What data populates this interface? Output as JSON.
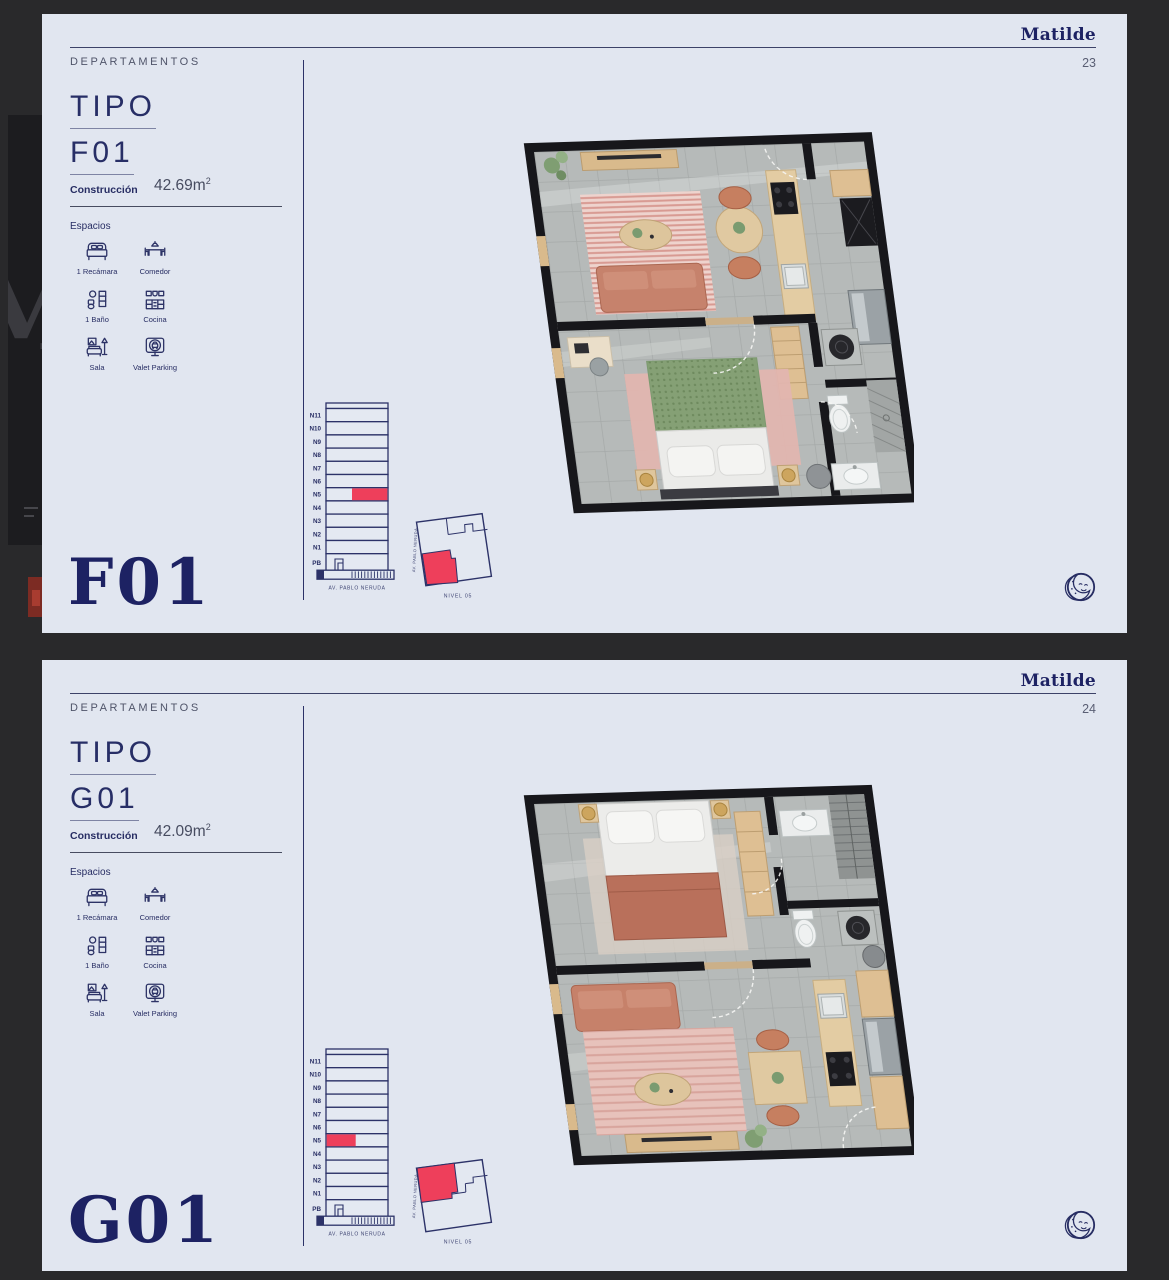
{
  "background": {
    "letter": "M"
  },
  "pages": [
    {
      "brand": "Matilde",
      "page_number": "23",
      "section_label": "DEPARTAMENTOS",
      "tipo": {
        "line1": "TIPO",
        "line2": "F01"
      },
      "construction": {
        "label": "Construcción",
        "value": "42.69m",
        "sup": "2"
      },
      "espacios_label": "Espacios",
      "spaces": [
        {
          "icon": "bed-icon",
          "label": "1 Recámara"
        },
        {
          "icon": "dining-icon",
          "label": "Comedor"
        },
        {
          "icon": "bath-icon",
          "label": "1 Baño"
        },
        {
          "icon": "kitchen-icon",
          "label": "Cocina"
        },
        {
          "icon": "sofa-icon",
          "label": "Sala"
        },
        {
          "icon": "valet-icon",
          "label": "Valet Parking"
        }
      ],
      "building": {
        "floors": [
          "N11",
          "N10",
          "N9",
          "N8",
          "N7",
          "N6",
          "N5",
          "N4",
          "N3",
          "N2",
          "N1",
          "PB"
        ],
        "highlight_floor": "N5",
        "highlight_side": "right",
        "street_label": "AV. PABLO NERUDA"
      },
      "siteplan": {
        "street_label": "AV. PABLO NERUDA",
        "level_label": "NIVEL 05",
        "highlight_position": "bottom-left"
      },
      "big_label": "F01"
    },
    {
      "brand": "Matilde",
      "page_number": "24",
      "section_label": "DEPARTAMENTOS",
      "tipo": {
        "line1": "TIPO",
        "line2": "G01"
      },
      "construction": {
        "label": "Construcción",
        "value": "42.09m",
        "sup": "2"
      },
      "espacios_label": "Espacios",
      "spaces": [
        {
          "icon": "bed-icon",
          "label": "1 Recámara"
        },
        {
          "icon": "dining-icon",
          "label": "Comedor"
        },
        {
          "icon": "bath-icon",
          "label": "1 Baño"
        },
        {
          "icon": "kitchen-icon",
          "label": "Cocina"
        },
        {
          "icon": "sofa-icon",
          "label": "Sala"
        },
        {
          "icon": "valet-icon",
          "label": "Valet Parking"
        }
      ],
      "building": {
        "floors": [
          "N11",
          "N10",
          "N9",
          "N8",
          "N7",
          "N6",
          "N5",
          "N4",
          "N3",
          "N2",
          "N1",
          "PB"
        ],
        "highlight_floor": "N5",
        "highlight_side": "left",
        "street_label": "AV. PABLO NERUDA"
      },
      "siteplan": {
        "street_label": "AV. PABLO NERUDA",
        "level_label": "NIVEL 05",
        "highlight_position": "top-left"
      },
      "big_label": "G01"
    }
  ],
  "colors": {
    "navy": "#272d63",
    "red": "#ee3f5b",
    "page_bg": "#e1e6f0",
    "canvas_bg": "#29292b"
  }
}
